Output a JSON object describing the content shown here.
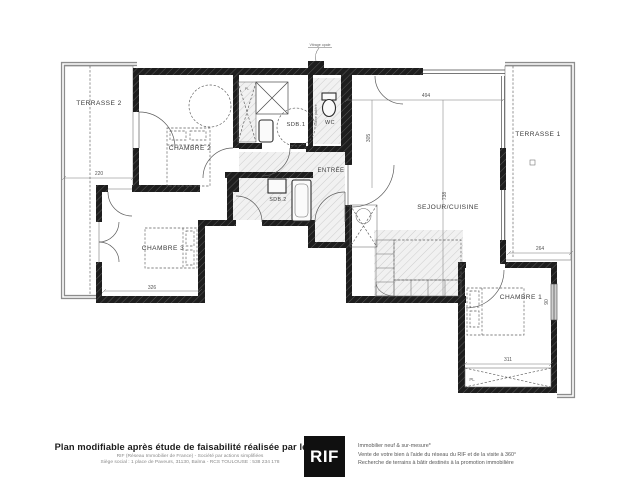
{
  "plan": {
    "labels": {
      "terrasse2": "TERRASSE 2",
      "terrasse1": "TERRASSE 1",
      "chambre2": "CHAMBRE 2",
      "chambre3": "CHAMBRE 3",
      "chambre1": "CHAMBRE 1",
      "sdb1": "SDB.1",
      "sdb2": "SDB.2",
      "wc": "WC",
      "entree": "ENTRÉE",
      "sejour": "SEJOUR/CUISINE",
      "placard_chambre1": "PL",
      "placard_sdb1": "PL"
    },
    "dims": {
      "terrasse2_width": "220",
      "chambre3_width": "326",
      "sejour_width": "494",
      "sejour_depth": "738",
      "entree_depth": "305",
      "terrasse1_bottom": "264",
      "chambre1_width": "311",
      "chambre1_window": "90"
    },
    "annotations": {
      "window_note": "Vitrage opale",
      "duct": "Gaine palière"
    }
  },
  "footer": {
    "left_bold": "Plan modifiable après étude de faisabilité réalisée par le RIF",
    "left_sub1": "RIF (Réseau Immobilier de France) - Société par actions simplifiées",
    "left_sub2": "Siège social : 1 place de Paveurs, 31130, Balma - RCS TOULOUSE : 538 234 178",
    "logo": "RIF",
    "right_line1": "Immobilier neuf & sur-mesure*",
    "right_line2": "Vente de votre bien à l'aide du réseau du RIF et de la visite à 360°",
    "right_line3": "Recherche de terrains à bâtir destinés à la promotion immobilière"
  }
}
